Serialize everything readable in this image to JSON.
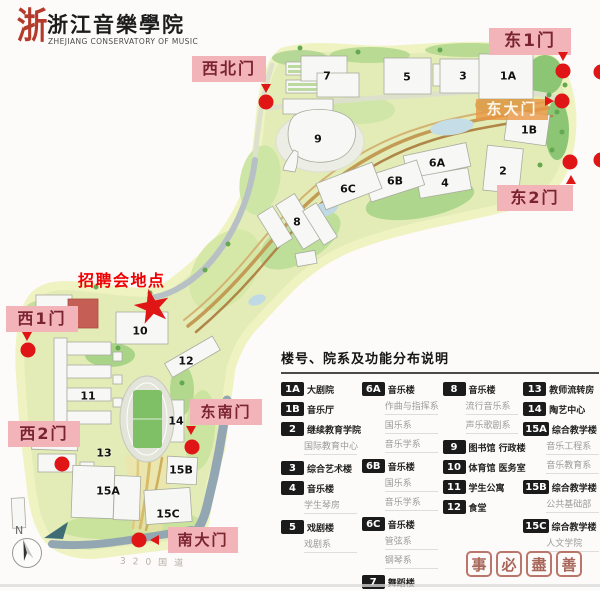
{
  "logo": {
    "seal_char": "浙",
    "title_cn": "浙江音樂學院",
    "title_en": "ZHEJIANG CONSERVATORY OF MUSIC"
  },
  "annotation": {
    "job_fair": "招聘会地点",
    "star": "★"
  },
  "gates": [
    {
      "label": "西北门"
    },
    {
      "label": "东1门"
    },
    {
      "label": "东大门"
    },
    {
      "label": "东2门"
    },
    {
      "label": "西1门"
    },
    {
      "label": "西2门"
    },
    {
      "label": "东南门"
    },
    {
      "label": "南大门"
    }
  ],
  "map": {
    "buildings": [
      "7",
      "5",
      "3",
      "1A",
      "9",
      "1B",
      "6A",
      "2",
      "6B",
      "4",
      "6C",
      "8",
      "10",
      "12",
      "11",
      "14",
      "13",
      "15B",
      "15A",
      "15C"
    ],
    "road_label": "320国道",
    "compass_north": "N"
  },
  "legend": {
    "title": "楼号、院系及功能分布说明",
    "columns": [
      {
        "items": [
          {
            "badge": "1A",
            "name": "大剧院",
            "subs": []
          },
          {
            "badge": "1B",
            "name": "音乐厅",
            "subs": []
          },
          {
            "badge": "2",
            "name": "继续教育学院",
            "subs": [
              "国际教育中心"
            ]
          },
          {
            "badge": "3",
            "name": "综合艺术楼",
            "subs": []
          },
          {
            "badge": "4",
            "name": "音乐楼",
            "subs": [
              "学生琴房"
            ]
          },
          {
            "badge": "5",
            "name": "戏剧楼",
            "subs": [
              "戏剧系"
            ]
          }
        ]
      },
      {
        "items": [
          {
            "badge": "6A",
            "name": "音乐楼",
            "subs": [
              "作曲与指挥系",
              "国乐系",
              "音乐学系"
            ]
          },
          {
            "badge": "6B",
            "name": "音乐楼",
            "subs": [
              "国乐系",
              "音乐学系"
            ]
          },
          {
            "badge": "6C",
            "name": "音乐楼",
            "subs": [
              "管弦系",
              "钢琴系"
            ]
          },
          {
            "badge": "7",
            "name": "舞蹈楼",
            "subs": [
              "舞蹈系"
            ]
          }
        ]
      },
      {
        "items": [
          {
            "badge": "8",
            "name": "音乐楼",
            "subs": [
              "流行音乐系",
              "声乐歌剧系"
            ]
          },
          {
            "badge": "9",
            "name": "图书馆 行政楼",
            "subs": []
          },
          {
            "badge": "10",
            "name": "体育馆 医务室",
            "subs": []
          },
          {
            "badge": "11",
            "name": "学生公寓",
            "subs": []
          },
          {
            "badge": "12",
            "name": "食堂",
            "subs": []
          }
        ]
      },
      {
        "items": [
          {
            "badge": "13",
            "name": "教师流转房",
            "subs": []
          },
          {
            "badge": "14",
            "name": "陶艺中心",
            "subs": []
          },
          {
            "badge": "15A",
            "name": "综合教学楼",
            "subs": [
              "音乐工程系",
              "音乐教育系"
            ]
          },
          {
            "badge": "15B",
            "name": "综合教学楼",
            "subs": [
              "公共基础部"
            ]
          },
          {
            "badge": "15C",
            "name": "综合教学楼",
            "subs": [
              "人文学院"
            ]
          }
        ]
      }
    ]
  },
  "watermark": {
    "chars": [
      "事",
      "必",
      "盡",
      "善"
    ]
  },
  "colors": {
    "accent_red": "#e01515",
    "gate_pink": "#f2b4b9",
    "gate_text": "#7a2430",
    "east_gate_orange": "#e8964a",
    "campus_green": "#e3ecb6",
    "badge_black": "#1b1b1b"
  }
}
